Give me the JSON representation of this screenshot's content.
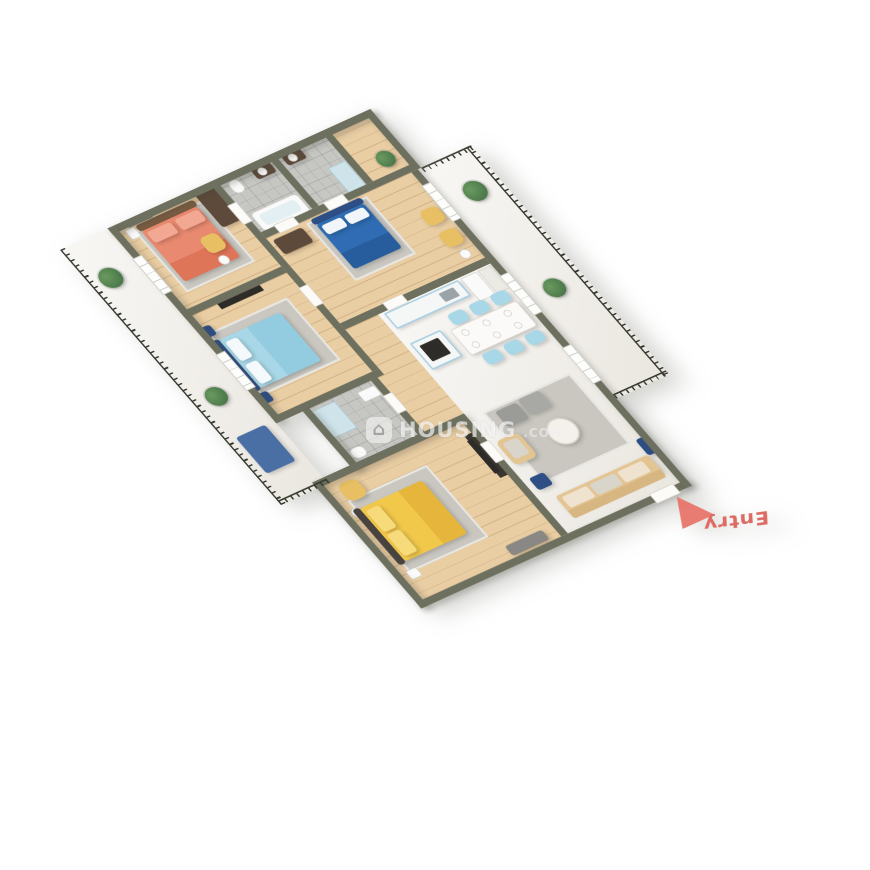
{
  "watermark": {
    "logo_icon": "house-icon",
    "logo_glyph": "⌂",
    "brand": "HOUSING",
    "tld": ".COM"
  },
  "entry": {
    "label": "Entry"
  },
  "colors": {
    "background": "#ffffff",
    "wall": "#6d705e",
    "wood": "#e9cda3",
    "marble": "#f2efe9",
    "tile": "#c6c6c2",
    "rug": "#c9c7c0",
    "rail": "#35382f",
    "plant": "#3f6b42",
    "white_fixture": "#fafafa",
    "coral": "#e98a70",
    "coral_dark": "#df7558",
    "coral_light": "#f2a893",
    "light_blue": "#a8d8e8",
    "blue": "#2f6cb3",
    "navy": "#2e4e86",
    "yellow": "#f2c84b",
    "yellow_light": "#f7da7a",
    "tan_chair": "#e8c063",
    "beige_sofa": "#e3c594",
    "beige_dark": "#d7b682",
    "cabinet_blue": "#a6cfe3",
    "dark_brown": "#5d4a3a",
    "dark_tv": "#2e2c28",
    "grey_bench": "#8a8884",
    "entry": "#e8766d",
    "entry_text": "#dd6b63"
  }
}
